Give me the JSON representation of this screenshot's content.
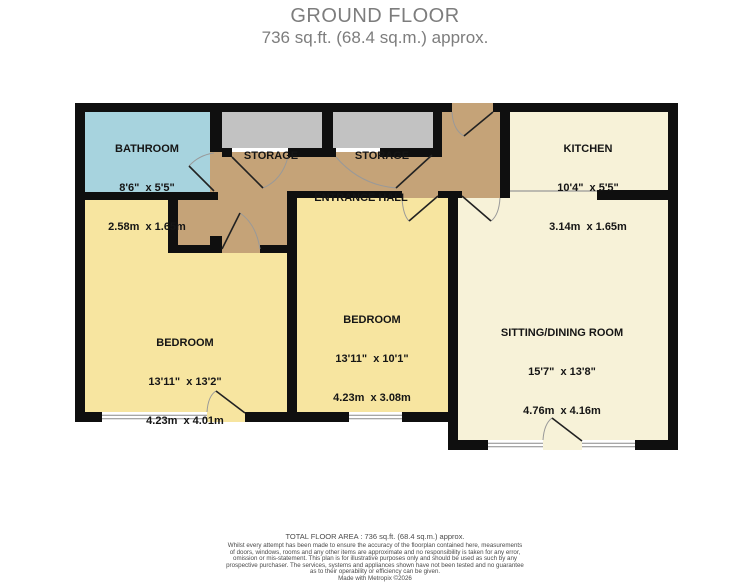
{
  "header": {
    "title": "GROUND FLOOR",
    "subtitle": "736 sq.ft. (68.4 sq.m.) approx."
  },
  "rooms": {
    "bathroom": {
      "name": "BATHROOM",
      "dims_ft": "8'6\"  x 5'5\"",
      "dims_m": "2.58m  x 1.65m"
    },
    "storage1": {
      "name": "STORAGE"
    },
    "storage2": {
      "name": "STORAGE"
    },
    "kitchen": {
      "name": "KITCHEN",
      "dims_ft": "10'4\"  x 5'5\"",
      "dims_m": "3.14m  x 1.65m"
    },
    "entrance_hall": {
      "name": "ENTRANCE HALL"
    },
    "bedroom1": {
      "name": "BEDROOM",
      "dims_ft": "13'11\"  x 13'2\"",
      "dims_m": "4.23m  x 4.01m"
    },
    "bedroom2": {
      "name": "BEDROOM",
      "dims_ft": "13'11\"  x 10'1\"",
      "dims_m": "4.23m  x 3.08m"
    },
    "sitting": {
      "name": "SITTING/DINING ROOM",
      "dims_ft": "15'7\"  x 13'8\"",
      "dims_m": "4.76m  x 4.16m"
    }
  },
  "footer": {
    "total": "TOTAL FLOOR AREA : 736 sq.ft. (68.4 sq.m.) approx.",
    "disclaimer": [
      "Whilst every attempt has been made to ensure the accuracy of the floorplan contained here, measurements",
      "of doors, windows, rooms and any other items are approximate and no responsibility is taken for any error,",
      "omission or mis-statement. This plan is for illustrative purposes only and should be used as such by any",
      "prospective purchaser. The services, systems and appliances shown have not been tested and no guarantee",
      "as to their operability or efficiency can be given."
    ],
    "credit": "Made with Metropix ©2026"
  },
  "colors": {
    "bathroom": "#a7d3de",
    "storage": "#c2c2c2",
    "hall": "#c5a378",
    "bedroom": "#f7e5a0",
    "living": "#f7f2d8",
    "wall": "#0f0f0f",
    "door_arc": "#999999",
    "title_text": "#7d7d7d"
  }
}
